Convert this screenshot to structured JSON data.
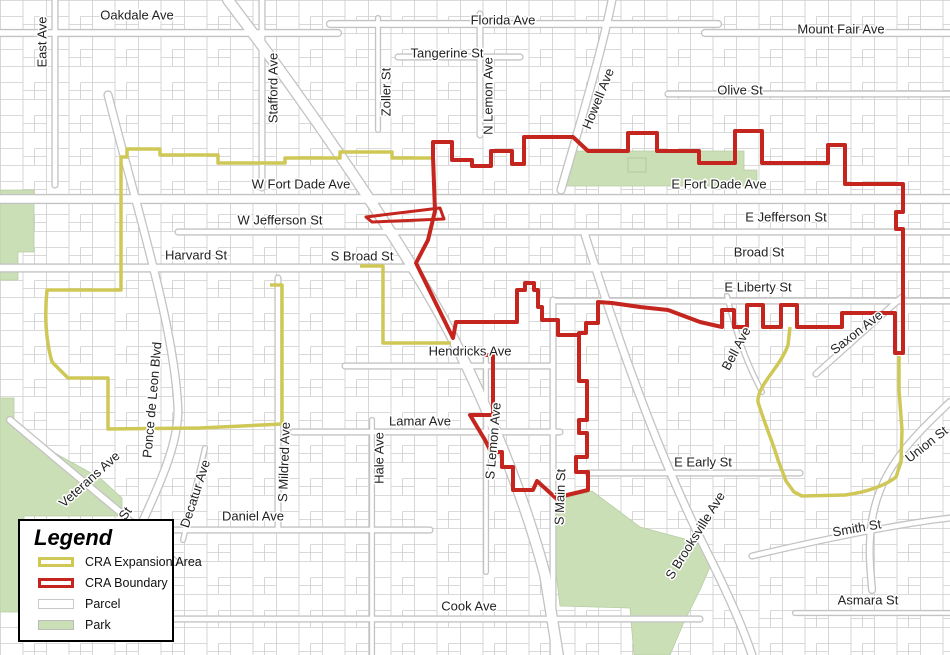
{
  "legend": {
    "title": "Legend",
    "items": [
      {
        "label": "CRA Expansion Area",
        "fill": "#ffffff",
        "border": "#cfc857",
        "border_width": 3
      },
      {
        "label": "CRA Boundary",
        "fill": "#ffffff",
        "border": "#c4251e",
        "border_width": 3
      },
      {
        "label": "Parcel",
        "fill": "#ffffff",
        "border": "#c9c9c9",
        "border_width": 1
      },
      {
        "label": "Park",
        "fill": "#cbdfb7",
        "border": "#bbbbbb",
        "border_width": 1
      }
    ]
  },
  "map": {
    "colors": {
      "cra_boundary": "#c4251e",
      "cra_expansion": "#cfc857",
      "park": "#cbdfb7",
      "parcel_line": "#cdcdcd",
      "label_text": "#222222"
    },
    "streets": [
      {
        "name": "Oakdale Ave",
        "x": 137,
        "y": 16,
        "rot": 0
      },
      {
        "name": "East Ave",
        "x": 43,
        "y": 42,
        "rot": -90
      },
      {
        "name": "Florida Ave",
        "x": 503,
        "y": 21,
        "rot": 0
      },
      {
        "name": "Tangerine St",
        "x": 447,
        "y": 54,
        "rot": 0
      },
      {
        "name": "Zoller St",
        "x": 387,
        "y": 92,
        "rot": -90
      },
      {
        "name": "N Lemon Ave",
        "x": 489,
        "y": 96,
        "rot": -90
      },
      {
        "name": "Howell Ave",
        "x": 599,
        "y": 99,
        "rot": -68
      },
      {
        "name": "Mount Fair Ave",
        "x": 841,
        "y": 30,
        "rot": 0
      },
      {
        "name": "Olive St",
        "x": 740,
        "y": 91,
        "rot": 0
      },
      {
        "name": "Stafford Ave",
        "x": 274,
        "y": 88,
        "rot": -90
      },
      {
        "name": "W Fort Dade Ave",
        "x": 301,
        "y": 185,
        "rot": 0
      },
      {
        "name": "E Fort Dade Ave",
        "x": 719,
        "y": 185,
        "rot": 0
      },
      {
        "name": "W Jefferson St",
        "x": 280,
        "y": 221,
        "rot": 0
      },
      {
        "name": "E Jefferson St",
        "x": 786,
        "y": 218,
        "rot": 0
      },
      {
        "name": "Harvard St",
        "x": 196,
        "y": 256,
        "rot": 0
      },
      {
        "name": "S Broad St",
        "x": 362,
        "y": 257,
        "rot": 0
      },
      {
        "name": "Broad St",
        "x": 759,
        "y": 253,
        "rot": 0
      },
      {
        "name": "E Liberty St",
        "x": 758,
        "y": 288,
        "rot": 0
      },
      {
        "name": "Hendricks Ave",
        "x": 470,
        "y": 352,
        "rot": 0
      },
      {
        "name": "Bell Ave",
        "x": 737,
        "y": 349,
        "rot": -62
      },
      {
        "name": "Saxon Ave",
        "x": 857,
        "y": 333,
        "rot": -38
      },
      {
        "name": "Ponce de Leon Blvd",
        "x": 153,
        "y": 400,
        "rot": -85
      },
      {
        "name": "Lamar Ave",
        "x": 420,
        "y": 422,
        "rot": 0
      },
      {
        "name": "Hale Ave",
        "x": 380,
        "y": 458,
        "rot": -90
      },
      {
        "name": "S Lemon Ave",
        "x": 494,
        "y": 441,
        "rot": -85
      },
      {
        "name": "S Main St",
        "x": 561,
        "y": 497,
        "rot": -88
      },
      {
        "name": "E Early St",
        "x": 703,
        "y": 463,
        "rot": 0
      },
      {
        "name": "Union St",
        "x": 927,
        "y": 445,
        "rot": -38
      },
      {
        "name": "Veterans Ave",
        "x": 90,
        "y": 480,
        "rot": -42
      },
      {
        "name": "St",
        "x": 126,
        "y": 514,
        "rot": -55
      },
      {
        "name": "Decatur Ave",
        "x": 196,
        "y": 494,
        "rot": -72
      },
      {
        "name": "S Mildred Ave",
        "x": 285,
        "y": 462,
        "rot": -88
      },
      {
        "name": "Daniel Ave",
        "x": 253,
        "y": 517,
        "rot": 0
      },
      {
        "name": "S Brooksville Ave",
        "x": 696,
        "y": 536,
        "rot": -58
      },
      {
        "name": "Smith St",
        "x": 857,
        "y": 529,
        "rot": -10
      },
      {
        "name": "Cook Ave",
        "x": 469,
        "y": 607,
        "rot": 0
      },
      {
        "name": "Asmara St",
        "x": 868,
        "y": 601,
        "rot": 0
      }
    ]
  }
}
